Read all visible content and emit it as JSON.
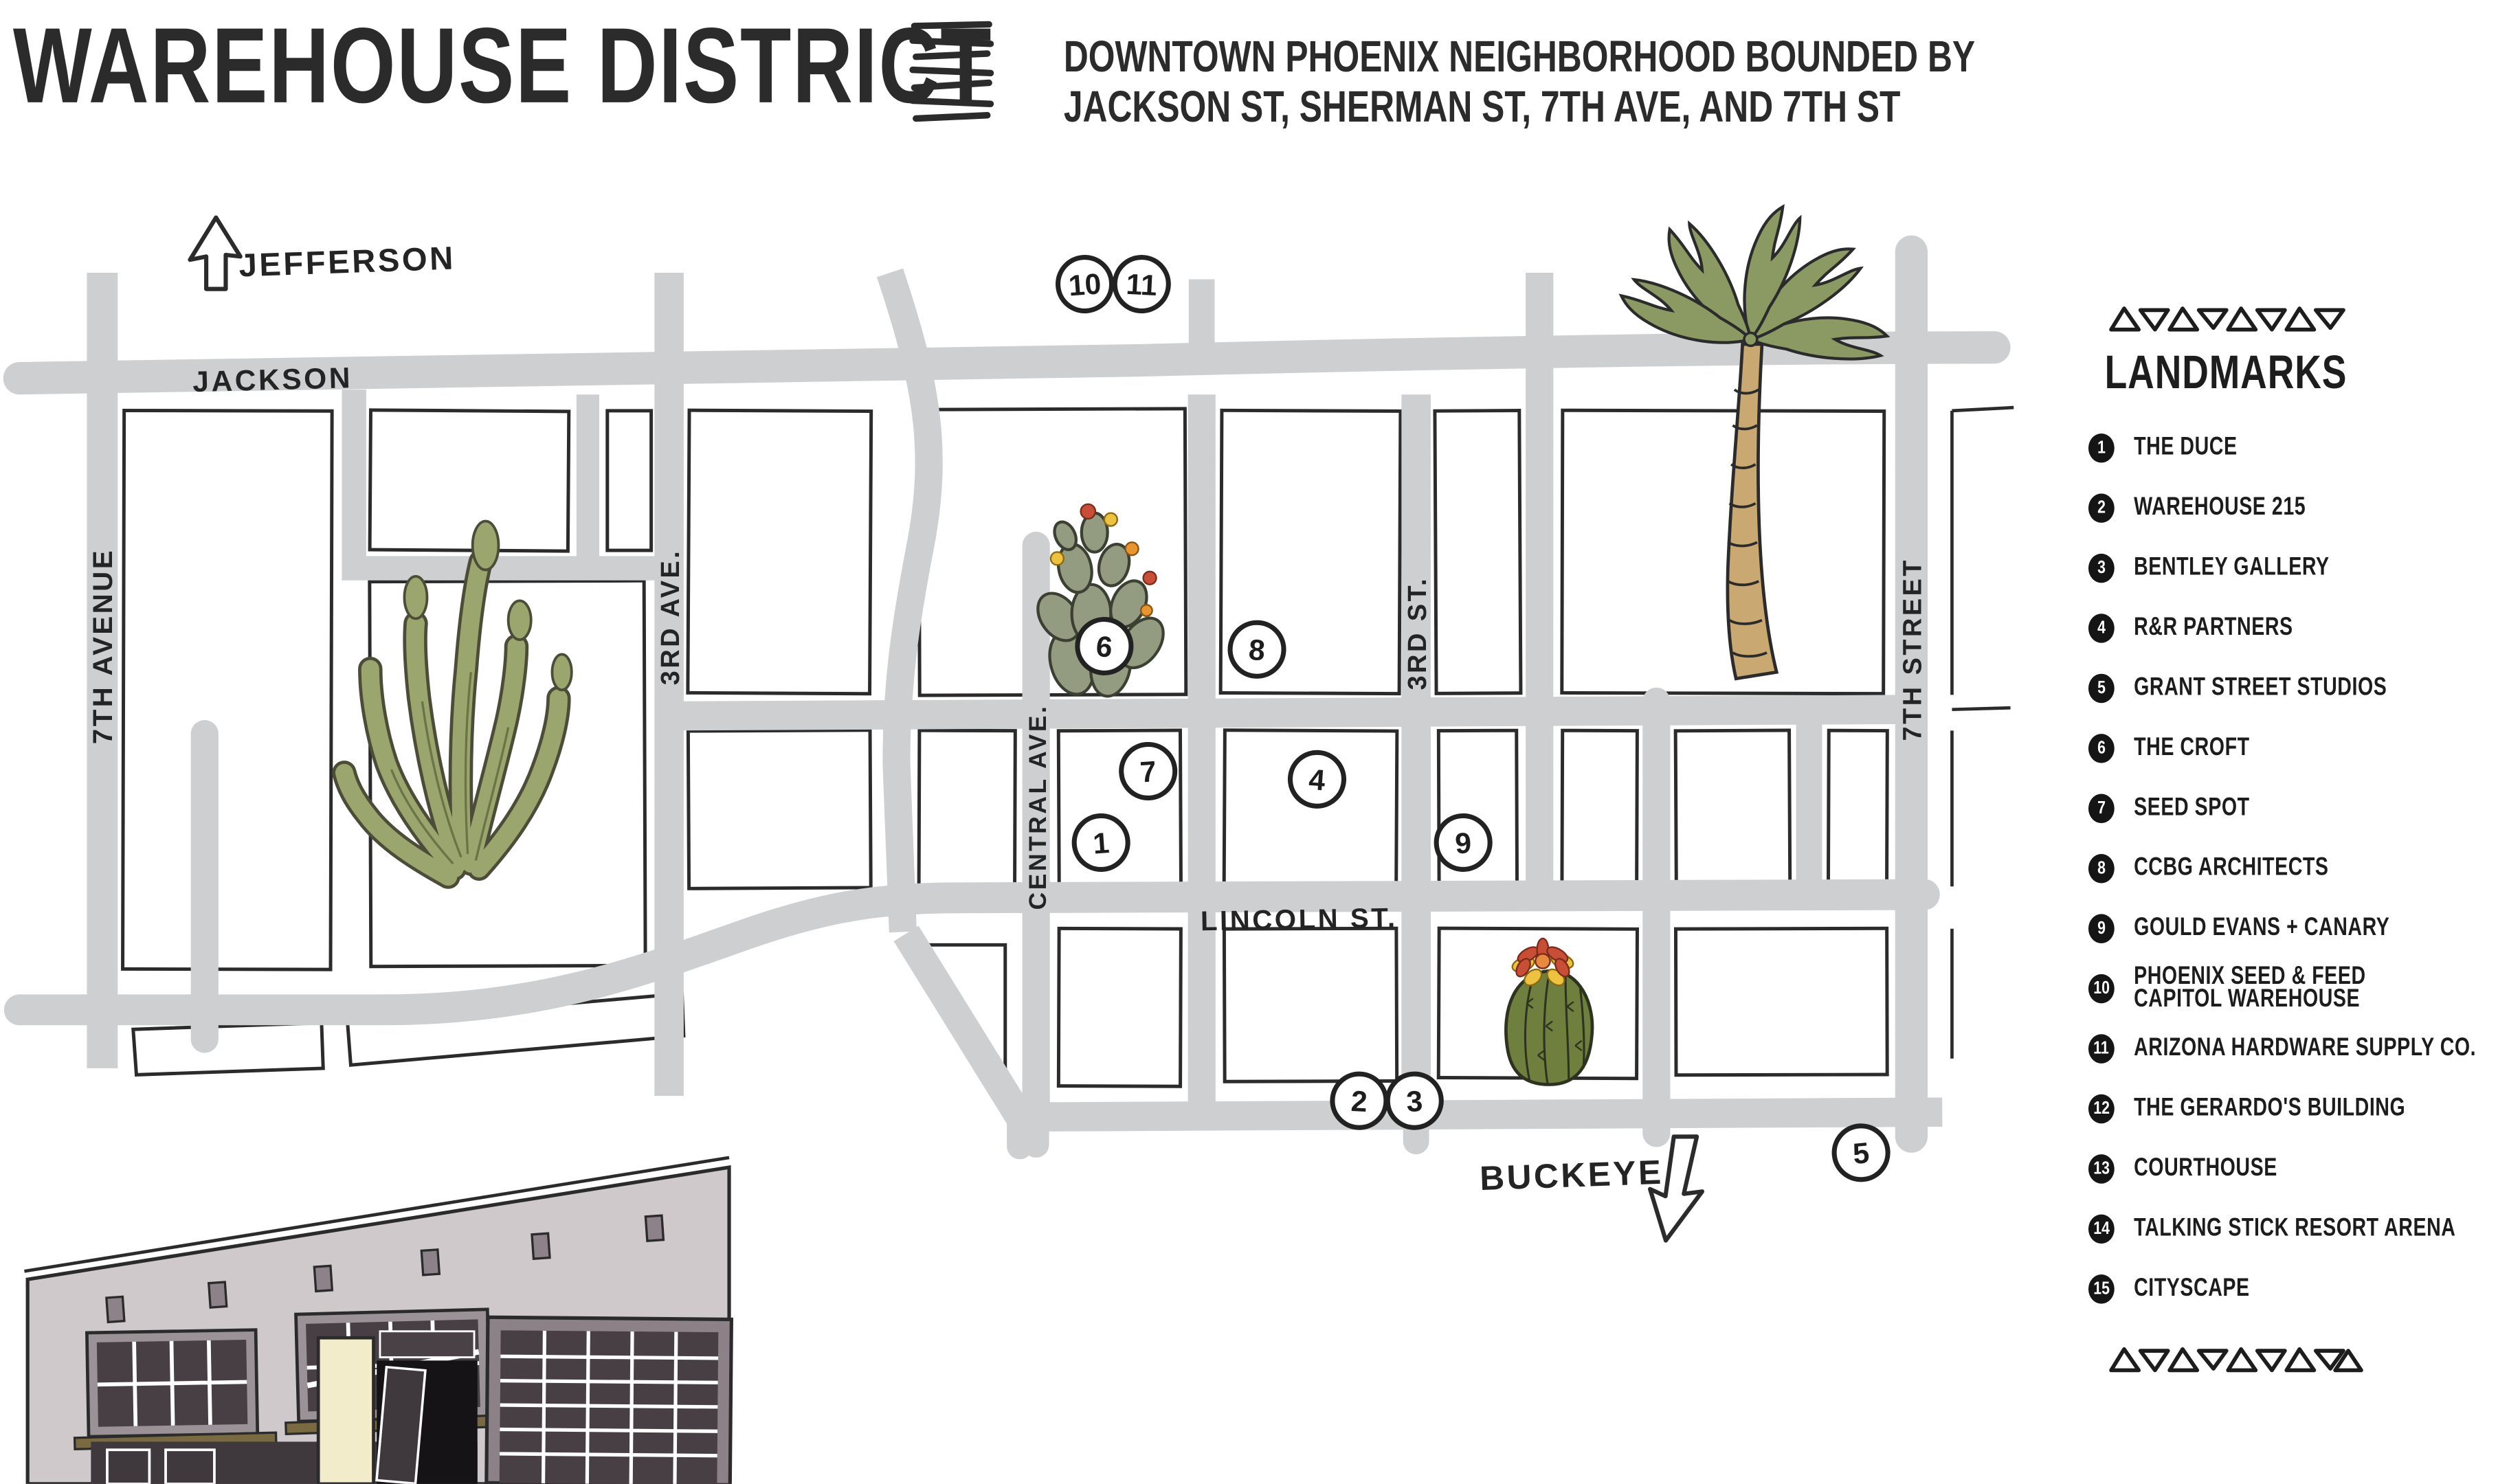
{
  "header": {
    "title": "WAREHOUSE DISTRICT",
    "subtitle_line1": "DOWNTOWN PHOENIX NEIGHBORHOOD BOUNDED BY",
    "subtitle_line2": "JACKSON ST, SHERMAN ST, 7TH AVE, AND 7TH ST"
  },
  "map": {
    "streets": {
      "jackson": "JACKSON",
      "seventh_ave": "7TH AVENUE",
      "third_ave": "3RD AVE.",
      "central_ave": "CENTRAL AVE.",
      "lincoln": "LINCOLN ST.",
      "third_st": "3RD ST.",
      "seventh_st": "7TH STREET",
      "jefferson": "JEFFERSON",
      "buckeye": "BUCKEYE"
    },
    "markers": [
      {
        "num": "1"
      },
      {
        "num": "2"
      },
      {
        "num": "3"
      },
      {
        "num": "4"
      },
      {
        "num": "5"
      },
      {
        "num": "6"
      },
      {
        "num": "7"
      },
      {
        "num": "8"
      },
      {
        "num": "9"
      },
      {
        "num": "10"
      },
      {
        "num": "11"
      }
    ]
  },
  "legend": {
    "heading": "LANDMARKS",
    "items": [
      {
        "num": "1",
        "label": "THE DUCE"
      },
      {
        "num": "2",
        "label": "WAREHOUSE 215"
      },
      {
        "num": "3",
        "label": "BENTLEY GALLERY"
      },
      {
        "num": "4",
        "label": "R&R PARTNERS"
      },
      {
        "num": "5",
        "label": "GRANT STREET STUDIOS"
      },
      {
        "num": "6",
        "label": "THE CROFT"
      },
      {
        "num": "7",
        "label": "SEED SPOT"
      },
      {
        "num": "8",
        "label": "CCBG ARCHITECTS"
      },
      {
        "num": "9",
        "label": "GOULD EVANS + CANARY"
      },
      {
        "num": "10",
        "label": "PHOENIX SEED & FEED",
        "label2": "CAPITOL WAREHOUSE"
      },
      {
        "num": "11",
        "label": "ARIZONA HARDWARE SUPPLY CO."
      },
      {
        "num": "12",
        "label": "THE GERARDO'S BUILDING"
      },
      {
        "num": "13",
        "label": "COURTHOUSE"
      },
      {
        "num": "14",
        "label": "TALKING STICK RESORT ARENA"
      },
      {
        "num": "15",
        "label": "CITYSCAPE"
      }
    ]
  },
  "colors": {
    "ink": "#272727",
    "road": "#cdcfd0",
    "organ_cactus_green": "#9aa66d",
    "prickly_pear_green": "#939c80",
    "barrel_cactus_green": "#6f7f3e",
    "palm_frond_green": "#8b9a62",
    "palm_trunk_tan": "#c9a871",
    "building_wall": "#cfc9cc",
    "window_dark": "#473f44",
    "awning_brown": "#7a6a41",
    "door_cream": "#f3ecca",
    "flower_red": "#c84f35",
    "flower_orange": "#e8952f",
    "flower_yellow": "#edc23f"
  }
}
